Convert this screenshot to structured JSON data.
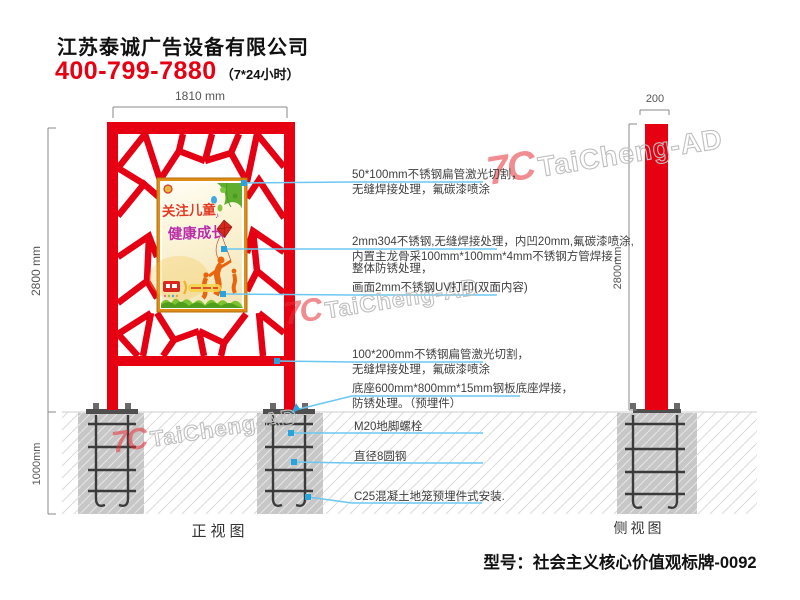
{
  "header": {
    "company": "江苏泰诚广告设备有限公司",
    "phone": "400-799-7880",
    "hours": "（7*24小时）"
  },
  "front_view": {
    "label": "正视图",
    "dim_width": "1810 mm",
    "dim_height": "2800 mm",
    "dim_depth": "1000mm"
  },
  "side_view": {
    "label": "侧视图",
    "dim_width": "200",
    "dim_height": "2800mm"
  },
  "poster": {
    "title_line1": "关注儿童",
    "title_line2": "健康成长",
    "note": "♪"
  },
  "annotations": [
    {
      "lines": [
        "50*100mm不锈钢扁管激光切割，",
        "无缝焊接处理，氟碳漆喷涂"
      ]
    },
    {
      "lines": [
        "2mm304不锈钢,无缝焊接处理，内凹20mm,氟碳漆喷涂,",
        "内置主龙骨采100mm*100mm*4mm不锈钢方管焊接，",
        "整体防锈处理，"
      ]
    },
    {
      "lines": [
        "画面2mm不锈钢UV打印(双面内容)"
      ]
    },
    {
      "lines": [
        "100*200mm不锈钢扁管激光切割，",
        "无缝焊接处理，氟碳漆喷涂"
      ]
    },
    {
      "lines": [
        "底座600mm*800mm*15mm钢板底座焊接，",
        "防锈处理。（预埋件）"
      ]
    },
    {
      "lines": [
        "M20地脚螺栓"
      ]
    },
    {
      "lines": [
        "直径8圆钢"
      ]
    },
    {
      "lines": [
        "C25混凝土地笼预埋件式安装."
      ]
    }
  ],
  "watermark": {
    "monogram": "7C",
    "brand": "TaiCheng-AD"
  },
  "footer": {
    "model": "型号：社会主义核心价值观标牌-0092"
  },
  "colors": {
    "frame_red": "#e60012",
    "leader_blue": "#6cc7f0",
    "dot_blue": "#2aa2db",
    "concrete_gray": "#c7c7c7",
    "poster_frame_orange": "#e08c17"
  }
}
